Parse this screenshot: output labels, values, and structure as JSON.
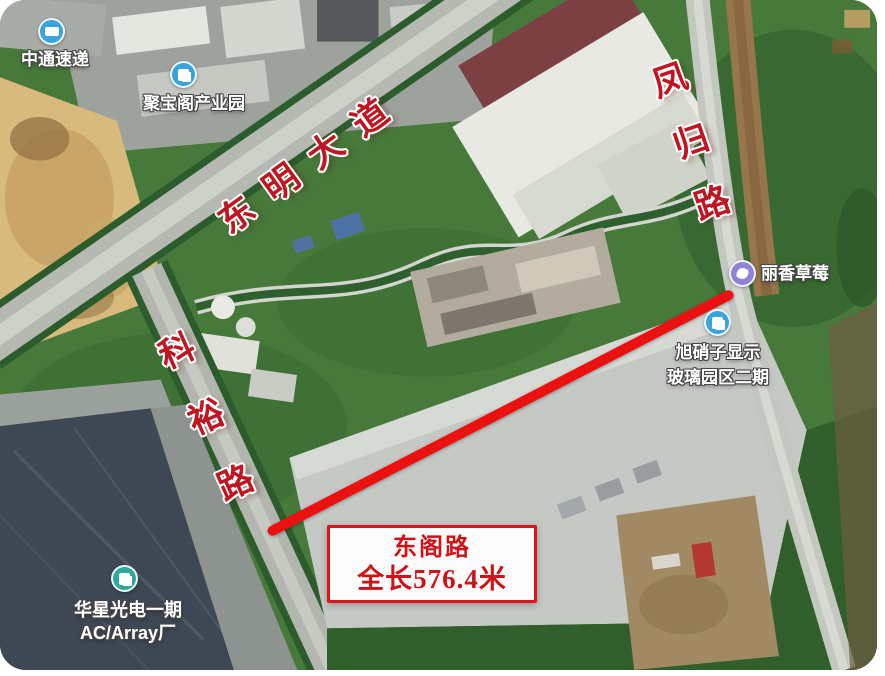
{
  "map": {
    "road_labels": {
      "dongming_avenue": "东明大道",
      "fenggui_road": "凤归路",
      "keyu_road": "科裕路"
    },
    "highlight": {
      "road_name": "东阁路",
      "length_label": "全长576.4米",
      "line_color": "#ec1111",
      "callout_border_color": "#d8151b",
      "label_text_color": "#c01622"
    },
    "pois": {
      "zhongtong": {
        "label": "中通速递",
        "marker_color": "#3aa4da"
      },
      "jubaoge": {
        "label": "聚宝阁产业园",
        "marker_color": "#3aa4da"
      },
      "xuxiaozi": {
        "label_line1": "旭硝子显示",
        "label_line2": "玻璃园区二期",
        "marker_color": "#3aa4da"
      },
      "huaxing": {
        "label_line1": "华星光电一期",
        "label_line2": "AC/Array厂",
        "marker_color": "#2fa89b"
      },
      "lixiang": {
        "label": "丽香草莓",
        "marker_color": "#8f83d8"
      }
    }
  }
}
